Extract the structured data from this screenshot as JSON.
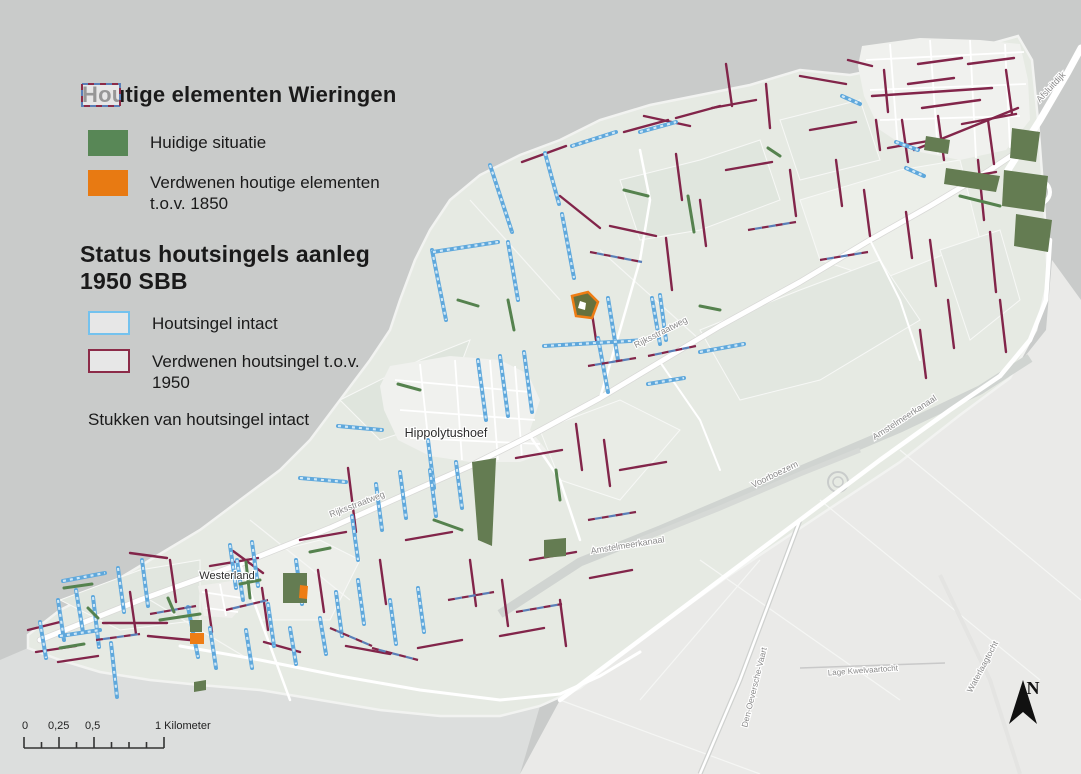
{
  "legend": {
    "s1": {
      "title": "Houtige elementen Wieringen",
      "items": [
        {
          "label": "Huidige situatie",
          "color": "#588756",
          "style": "fill"
        },
        {
          "label": "Verdwenen houtige elementen t.o.v. 1850",
          "color": "#e87a12",
          "style": "fill"
        }
      ]
    },
    "s2": {
      "title": "Status houtsingels aanleg 1950 SBB",
      "items": [
        {
          "label": "Houtsingel intact",
          "color": "#74c2ee",
          "style": "outline"
        },
        {
          "label": "Verdwenen houtsingel t.o.v. 1950",
          "color": "#8c2b48",
          "style": "outline"
        },
        {
          "label": "Stukken van houtsingel intact",
          "color": "#5a7fb8",
          "color2": "#8c2b48",
          "style": "dashed-outline"
        }
      ]
    }
  },
  "scale_bar": {
    "marks": [
      "0",
      "0,25",
      "0,5"
    ],
    "unit": "1 Kilometer"
  },
  "north_arrow": {
    "label": "N"
  },
  "colors": {
    "sea": "#c9cbca",
    "island": "#e6eae3",
    "polder": "#eaeae8",
    "water_zuid": "#dcdedd",
    "town": "#f0f1ee",
    "road": "#ffffff",
    "canal": "#d0d4d1",
    "groen": "#55824e",
    "groen_donker": "#647c52",
    "olijf": "#66713d",
    "oranje": "#ee7d15",
    "blauw": "#5fa8dc",
    "blauw_licht": "#cfe8f7",
    "bordeaux": "#82254a",
    "dash_blauw": "#5a7fb8",
    "label_plaats": "#2c2c2c",
    "label_weg": "#8a8a8a"
  },
  "map_labels": [
    {
      "text": "Hippolytushoef",
      "x": 446,
      "y": 437,
      "size": 12.5,
      "rot": 0,
      "kind": "plaats"
    },
    {
      "text": "Westerland",
      "x": 227,
      "y": 579,
      "size": 11,
      "rot": 0,
      "kind": "plaats"
    },
    {
      "text": "Rijksstraatweg",
      "x": 358,
      "y": 507,
      "size": 9,
      "rot": -21,
      "kind": "weg"
    },
    {
      "text": "Rijksstraatweg",
      "x": 662,
      "y": 335,
      "size": 9,
      "rot": -27,
      "kind": "weg"
    },
    {
      "text": "Amstelmeerkanaal",
      "x": 628,
      "y": 548,
      "size": 9,
      "rot": -9,
      "kind": "weg"
    },
    {
      "text": "Voorboezem",
      "x": 776,
      "y": 477,
      "size": 9,
      "rot": -26,
      "kind": "weg"
    },
    {
      "text": "Amstelmeerkanaal",
      "x": 906,
      "y": 420,
      "size": 9,
      "rot": -33,
      "kind": "weg"
    },
    {
      "text": "Afsluitdijk",
      "x": 1053,
      "y": 89,
      "size": 9,
      "rot": -47,
      "kind": "weg"
    },
    {
      "text": "Den-Oeversche-Vaart",
      "x": 757,
      "y": 688,
      "size": 8.5,
      "rot": -76,
      "kind": "weg"
    },
    {
      "text": "Lage Kwelvaartocht",
      "x": 863,
      "y": 673,
      "size": 8,
      "rot": -4,
      "kind": "weg"
    },
    {
      "text": "Waterlaagtocht",
      "x": 985,
      "y": 668,
      "size": 8.5,
      "rot": -62,
      "kind": "weg"
    }
  ],
  "features": {
    "intact": [
      [
        40,
        622,
        46,
        658
      ],
      [
        58,
        600,
        64,
        640
      ],
      [
        76,
        590,
        83,
        632
      ],
      [
        93,
        597,
        99,
        647
      ],
      [
        111,
        643,
        117,
        697
      ],
      [
        118,
        568,
        124,
        612
      ],
      [
        188,
        607,
        198,
        657
      ],
      [
        142,
        560,
        148,
        606
      ],
      [
        230,
        545,
        236,
        588
      ],
      [
        252,
        542,
        258,
        586
      ],
      [
        268,
        604,
        274,
        646
      ],
      [
        296,
        560,
        302,
        604
      ],
      [
        60,
        636,
        100,
        630
      ],
      [
        63,
        581,
        105,
        573
      ],
      [
        210,
        628,
        216,
        668
      ],
      [
        246,
        630,
        252,
        668
      ],
      [
        290,
        628,
        296,
        664
      ],
      [
        237,
        560,
        243,
        600
      ],
      [
        320,
        618,
        326,
        654
      ],
      [
        336,
        592,
        342,
        636
      ],
      [
        358,
        580,
        364,
        624
      ],
      [
        390,
        600,
        396,
        644
      ],
      [
        418,
        588,
        424,
        632
      ],
      [
        352,
        516,
        358,
        560
      ],
      [
        376,
        484,
        382,
        530
      ],
      [
        400,
        472,
        406,
        518
      ],
      [
        428,
        440,
        434,
        488
      ],
      [
        338,
        426,
        382,
        430
      ],
      [
        300,
        478,
        346,
        482
      ],
      [
        430,
        470,
        436,
        516
      ],
      [
        456,
        462,
        462,
        508
      ],
      [
        490,
        165,
        512,
        232
      ],
      [
        545,
        153,
        559,
        204
      ],
      [
        432,
        250,
        446,
        320
      ],
      [
        433,
        252,
        498,
        242
      ],
      [
        508,
        242,
        518,
        300
      ],
      [
        562,
        214,
        574,
        278
      ],
      [
        608,
        298,
        618,
        360
      ],
      [
        652,
        298,
        660,
        344
      ],
      [
        598,
        338,
        608,
        392
      ],
      [
        544,
        346,
        646,
        340
      ],
      [
        478,
        360,
        486,
        420
      ],
      [
        500,
        356,
        508,
        416
      ],
      [
        524,
        352,
        532,
        412
      ],
      [
        572,
        146,
        616,
        132
      ],
      [
        640,
        132,
        676,
        122
      ],
      [
        660,
        295,
        666,
        340
      ],
      [
        700,
        352,
        744,
        344
      ],
      [
        648,
        384,
        684,
        378
      ],
      [
        896,
        142,
        918,
        150
      ],
      [
        906,
        168,
        924,
        176
      ],
      [
        842,
        96,
        860,
        104
      ]
    ],
    "verdwenen": [
      [
        130,
        553,
        167,
        558
      ],
      [
        233,
        551,
        263,
        573
      ],
      [
        103,
        623,
        167,
        623
      ],
      [
        28,
        630,
        60,
        622
      ],
      [
        36,
        652,
        76,
        646
      ],
      [
        130,
        592,
        136,
        634
      ],
      [
        206,
        590,
        212,
        632
      ],
      [
        170,
        560,
        176,
        602
      ],
      [
        262,
        588,
        268,
        630
      ],
      [
        300,
        540,
        346,
        532
      ],
      [
        210,
        566,
        258,
        558
      ],
      [
        58,
        662,
        98,
        656
      ],
      [
        148,
        636,
        190,
        640
      ],
      [
        264,
        642,
        300,
        652
      ],
      [
        318,
        570,
        324,
        612
      ],
      [
        348,
        468,
        356,
        532
      ],
      [
        406,
        540,
        452,
        532
      ],
      [
        470,
        560,
        476,
        606
      ],
      [
        502,
        580,
        508,
        626
      ],
      [
        530,
        560,
        576,
        552
      ],
      [
        560,
        600,
        566,
        646
      ],
      [
        590,
        578,
        632,
        570
      ],
      [
        380,
        560,
        386,
        604
      ],
      [
        418,
        648,
        462,
        640
      ],
      [
        346,
        646,
        390,
        654
      ],
      [
        500,
        636,
        544,
        628
      ],
      [
        576,
        424,
        582,
        470
      ],
      [
        604,
        440,
        610,
        486
      ],
      [
        516,
        458,
        562,
        450
      ],
      [
        620,
        470,
        666,
        462
      ],
      [
        560,
        196,
        600,
        228
      ],
      [
        610,
        226,
        656,
        236
      ],
      [
        666,
        238,
        672,
        290
      ],
      [
        700,
        200,
        706,
        246
      ],
      [
        676,
        154,
        682,
        200
      ],
      [
        644,
        116,
        690,
        126
      ],
      [
        712,
        108,
        756,
        100
      ],
      [
        766,
        84,
        770,
        128
      ],
      [
        726,
        64,
        732,
        106
      ],
      [
        800,
        76,
        846,
        84
      ],
      [
        522,
        162,
        566,
        146
      ],
      [
        624,
        132,
        668,
        120
      ],
      [
        676,
        118,
        720,
        106
      ],
      [
        590,
        300,
        596,
        340
      ],
      [
        726,
        170,
        772,
        162
      ],
      [
        790,
        170,
        796,
        216
      ],
      [
        810,
        130,
        856,
        122
      ],
      [
        836,
        160,
        842,
        206
      ],
      [
        864,
        190,
        870,
        236
      ],
      [
        888,
        148,
        934,
        140
      ],
      [
        906,
        212,
        912,
        258
      ],
      [
        930,
        240,
        936,
        286
      ],
      [
        950,
        180,
        996,
        172
      ],
      [
        978,
        160,
        984,
        220
      ],
      [
        990,
        232,
        996,
        292
      ],
      [
        1000,
        300,
        1006,
        352
      ],
      [
        948,
        300,
        954,
        348
      ],
      [
        920,
        330,
        926,
        378
      ],
      [
        872,
        96,
        992,
        88
      ],
      [
        884,
        70,
        888,
        112
      ],
      [
        908,
        84,
        954,
        78
      ],
      [
        922,
        108,
        980,
        100
      ],
      [
        938,
        116,
        944,
        160
      ],
      [
        962,
        124,
        1016,
        114
      ],
      [
        968,
        64,
        1014,
        58
      ],
      [
        1006,
        70,
        1012,
        114
      ],
      [
        988,
        120,
        994,
        164
      ],
      [
        918,
        64,
        962,
        58
      ],
      [
        902,
        120,
        908,
        162
      ],
      [
        914,
        150,
        1018,
        108
      ],
      [
        876,
        120,
        880,
        150
      ],
      [
        848,
        60,
        872,
        66
      ]
    ],
    "stukken": [
      [
        150,
        614,
        196,
        606
      ],
      [
        226,
        610,
        268,
        600
      ],
      [
        330,
        628,
        372,
        646
      ],
      [
        96,
        640,
        140,
        634
      ],
      [
        588,
        366,
        636,
        358
      ],
      [
        648,
        356,
        696,
        346
      ],
      [
        590,
        252,
        642,
        262
      ],
      [
        748,
        230,
        796,
        222
      ],
      [
        820,
        260,
        868,
        252
      ],
      [
        448,
        600,
        494,
        592
      ],
      [
        516,
        612,
        562,
        604
      ],
      [
        588,
        520,
        636,
        512
      ],
      [
        372,
        648,
        418,
        660
      ]
    ],
    "groen_lijnen": [
      [
        64,
        588,
        92,
        584
      ],
      [
        160,
        620,
        200,
        614
      ],
      [
        60,
        648,
        84,
        644
      ],
      [
        168,
        598,
        174,
        612
      ],
      [
        88,
        608,
        98,
        618
      ],
      [
        246,
        562,
        250,
        598
      ],
      [
        688,
        196,
        694,
        232
      ],
      [
        398,
        384,
        420,
        390
      ],
      [
        700,
        306,
        720,
        310
      ],
      [
        434,
        520,
        462,
        530
      ],
      [
        768,
        148,
        780,
        156
      ],
      [
        556,
        470,
        560,
        500
      ],
      [
        310,
        552,
        330,
        548
      ],
      [
        240,
        584,
        260,
        580
      ],
      [
        624,
        190,
        648,
        196
      ],
      [
        458,
        300,
        478,
        306
      ],
      [
        508,
        300,
        514,
        330
      ],
      [
        960,
        196,
        1000,
        206
      ]
    ],
    "polys": [
      {
        "pts": "472,462 496,458 492,546 478,540",
        "fill": "groen_donker"
      },
      {
        "pts": "544,540 566,538 566,556 544,558",
        "fill": "groen_donker"
      },
      {
        "pts": "283,573 307,573 307,603 283,603",
        "fill": "groen_donker"
      },
      {
        "pts": "300,585 308,586 307,599 299,598",
        "fill": "oranje"
      },
      {
        "pts": "190,620 202,620 202,632 190,632",
        "fill": "groen_donker"
      },
      {
        "pts": "190,633 204,633 204,644 190,644",
        "fill": "oranje"
      },
      {
        "pts": "194,682 206,680 206,690 194,692",
        "fill": "groen_donker"
      },
      {
        "pts": "572,296 588,292 598,302 592,318 576,316",
        "fill": "olijf",
        "stroke": "oranje"
      },
      {
        "pts": "580,301 586,303 585,310 578,308",
        "fill": "#ffffff"
      },
      {
        "pts": "926,136 950,140 948,154 924,150",
        "fill": "groen_donker"
      },
      {
        "pts": "946,168 1000,176 996,192 944,184",
        "fill": "groen_donker"
      },
      {
        "pts": "1012,128 1040,132 1036,162 1010,158",
        "fill": "groen_donker"
      },
      {
        "pts": "1004,170 1048,176 1044,212 1002,206",
        "fill": "groen_donker"
      },
      {
        "pts": "1016,214 1052,220 1048,252 1014,246",
        "fill": "groen_donker"
      }
    ]
  }
}
